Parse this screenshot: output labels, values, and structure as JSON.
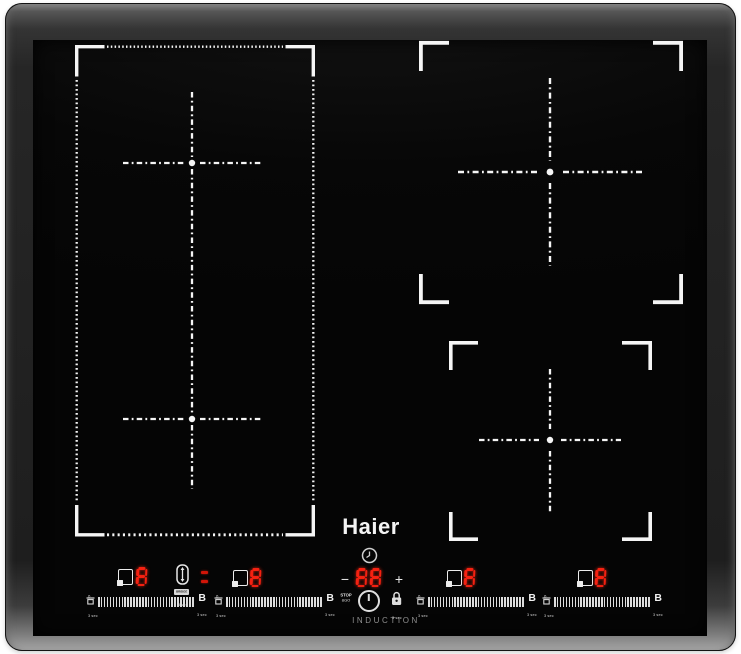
{
  "brand": {
    "logo": "Haier",
    "product_label": "INDUCTION"
  },
  "colors": {
    "led_red": "#ff2212",
    "marking_white": "#f5f5f5",
    "glass_black": "#060606",
    "frame_gray": "#2b2b2b"
  },
  "icons": [
    "pot-select-icon",
    "bridge-icon",
    "clock-icon",
    "pan-icon",
    "stop-and-go-key",
    "power-icon",
    "lock-icon",
    "boost-label"
  ],
  "controls": {
    "zone_displays": [
      {
        "id": "left-rear",
        "power": "8"
      },
      {
        "id": "left-front",
        "power": "8"
      },
      {
        "id": "right-rear",
        "power": "8"
      },
      {
        "id": "right-front",
        "power": "8"
      }
    ],
    "bridge": {
      "label": "BRIDGE",
      "hold_label": "3 sec"
    },
    "timer": {
      "value": "88",
      "minus_label": "−",
      "plus_label": "+"
    },
    "stop_go": {
      "line1": "STOP",
      "line2": "&GO"
    },
    "power_lock": {
      "hold_label": "3 sec"
    },
    "slider": {
      "min_label": "0",
      "boost_label": "B",
      "hold_label": "3 sec"
    }
  }
}
